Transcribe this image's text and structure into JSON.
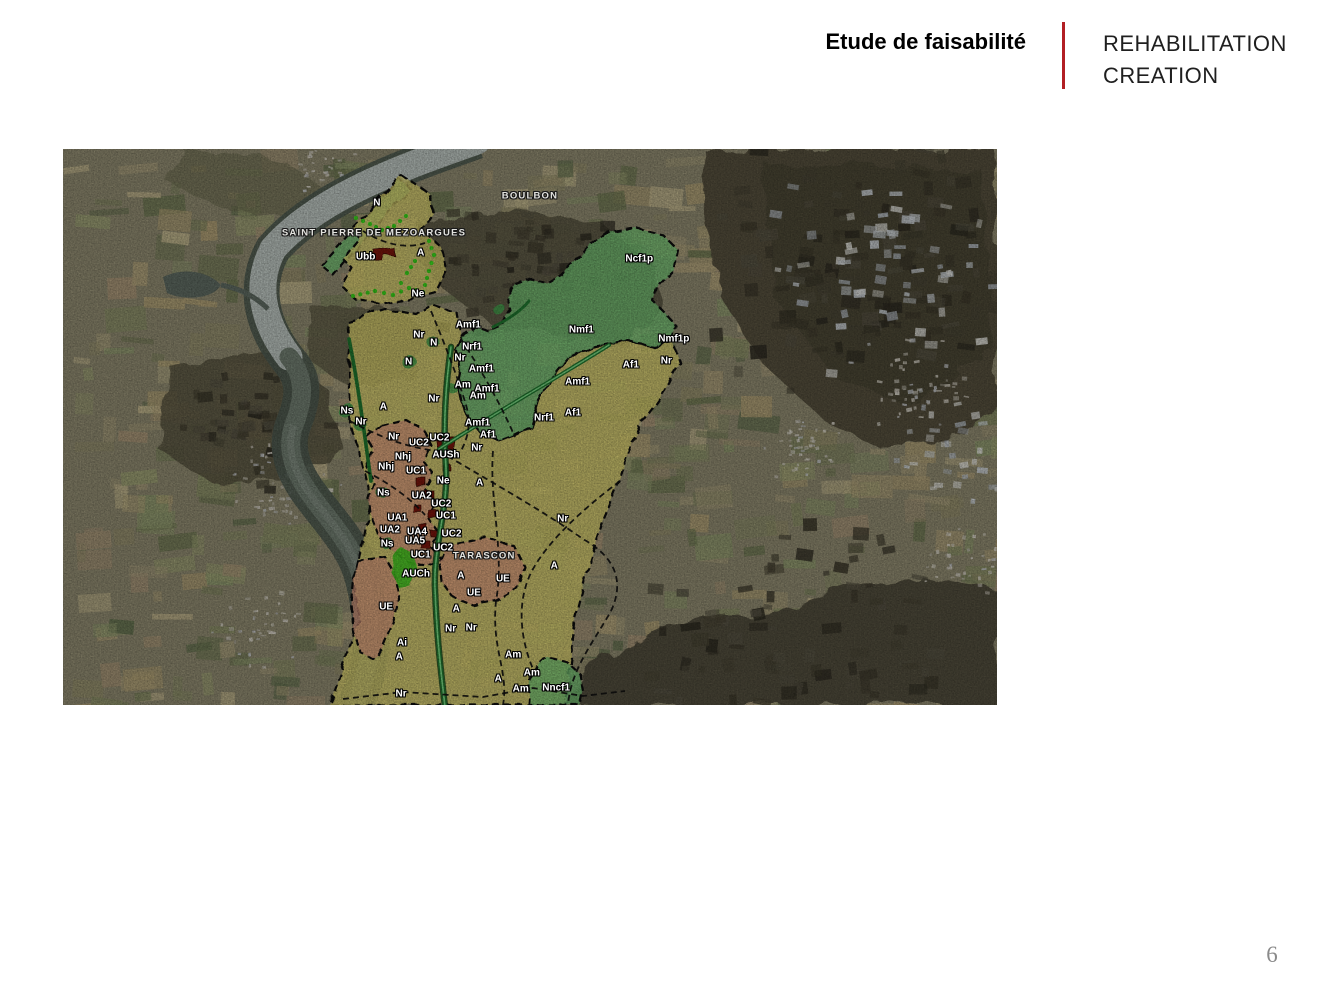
{
  "header": {
    "title": "Etude de faisabilité",
    "subtitle_line1": "REHABILITATION",
    "subtitle_line2": "CREATION",
    "accent_color": "#b21f24"
  },
  "footer": {
    "page_number": "6"
  },
  "map": {
    "kind": "satellite-aerial-with-zoning-overlay",
    "colors": {
      "agricultural_zone": "#d8ce6d",
      "natural_zone": "#74c173",
      "urban_zone": "#d8977c",
      "dense_urban_zone": "#7a150d",
      "future_urban_zone": "#44c522",
      "zone_border": "#0a0a0a",
      "dotted_line_green": "#3bd31d"
    },
    "place_labels": [
      {
        "text": "SAINT PIERRE DE MEZOARGUES",
        "x": 33.3,
        "y": 15.1
      },
      {
        "text": "BOULBON",
        "x": 50.0,
        "y": 8.5
      },
      {
        "text": "TARASCON",
        "x": 45.1,
        "y": 73.2
      }
    ],
    "zone_labels": [
      {
        "text": "N",
        "x": 33.6,
        "y": 9.7
      },
      {
        "text": "Ubb",
        "x": 32.4,
        "y": 19.4
      },
      {
        "text": "A",
        "x": 38.3,
        "y": 18.7
      },
      {
        "text": "Ne",
        "x": 38.0,
        "y": 26.1
      },
      {
        "text": "Ncf1p",
        "x": 61.7,
        "y": 19.8
      },
      {
        "text": "Amf1",
        "x": 43.4,
        "y": 31.7
      },
      {
        "text": "Nr",
        "x": 38.1,
        "y": 33.5
      },
      {
        "text": "N",
        "x": 39.7,
        "y": 34.9
      },
      {
        "text": "Nrf1",
        "x": 43.8,
        "y": 35.6
      },
      {
        "text": "Nmf1",
        "x": 55.5,
        "y": 32.6
      },
      {
        "text": "Nmf1p",
        "x": 65.4,
        "y": 34.2
      },
      {
        "text": "Nr",
        "x": 42.5,
        "y": 37.6
      },
      {
        "text": "Amf1",
        "x": 44.8,
        "y": 39.6
      },
      {
        "text": "Af1",
        "x": 60.8,
        "y": 38.8
      },
      {
        "text": "Nr",
        "x": 64.6,
        "y": 38.1
      },
      {
        "text": "Am",
        "x": 42.8,
        "y": 42.4
      },
      {
        "text": "Amf1",
        "x": 45.4,
        "y": 43.2
      },
      {
        "text": "Amf1",
        "x": 55.1,
        "y": 41.9
      },
      {
        "text": "Am",
        "x": 44.4,
        "y": 44.4
      },
      {
        "text": "Nr",
        "x": 39.7,
        "y": 45.0
      },
      {
        "text": "Ns",
        "x": 30.4,
        "y": 47.1
      },
      {
        "text": "A",
        "x": 34.3,
        "y": 46.4
      },
      {
        "text": "Nr",
        "x": 31.9,
        "y": 49.1
      },
      {
        "text": "N",
        "x": 37.0,
        "y": 38.3
      },
      {
        "text": "Nrf1",
        "x": 51.5,
        "y": 48.4
      },
      {
        "text": "Af1",
        "x": 54.6,
        "y": 47.5
      },
      {
        "text": "Amf1",
        "x": 44.4,
        "y": 49.3
      },
      {
        "text": "Af1",
        "x": 45.5,
        "y": 51.4
      },
      {
        "text": "Nr",
        "x": 35.4,
        "y": 51.8
      },
      {
        "text": "UC2",
        "x": 38.1,
        "y": 52.9
      },
      {
        "text": "UC2",
        "x": 40.3,
        "y": 52.0
      },
      {
        "text": "Nhj",
        "x": 36.4,
        "y": 55.4
      },
      {
        "text": "Nhj",
        "x": 34.6,
        "y": 57.2
      },
      {
        "text": "AUSh",
        "x": 41.0,
        "y": 55.0
      },
      {
        "text": "Nr",
        "x": 44.3,
        "y": 53.8
      },
      {
        "text": "UC1",
        "x": 37.8,
        "y": 57.9
      },
      {
        "text": "Ne",
        "x": 40.7,
        "y": 59.7
      },
      {
        "text": "A",
        "x": 44.6,
        "y": 60.1
      },
      {
        "text": "Ns",
        "x": 34.3,
        "y": 61.9
      },
      {
        "text": "UA2",
        "x": 38.4,
        "y": 62.4
      },
      {
        "text": "UC2",
        "x": 40.5,
        "y": 63.8
      },
      {
        "text": "UA1",
        "x": 35.8,
        "y": 66.4
      },
      {
        "text": "UC1",
        "x": 41.0,
        "y": 66.0
      },
      {
        "text": "UA2",
        "x": 35.0,
        "y": 68.5
      },
      {
        "text": "UA4",
        "x": 37.9,
        "y": 68.9
      },
      {
        "text": "UC2",
        "x": 41.6,
        "y": 69.2
      },
      {
        "text": "Ns",
        "x": 34.7,
        "y": 71.0
      },
      {
        "text": "UA5",
        "x": 37.7,
        "y": 70.5
      },
      {
        "text": "UC2",
        "x": 40.7,
        "y": 71.8
      },
      {
        "text": "UC1",
        "x": 38.3,
        "y": 73.0
      },
      {
        "text": "AUCh",
        "x": 37.8,
        "y": 76.4
      },
      {
        "text": "A",
        "x": 42.6,
        "y": 76.8
      },
      {
        "text": "UE",
        "x": 47.1,
        "y": 77.3
      },
      {
        "text": "A",
        "x": 52.6,
        "y": 75.0
      },
      {
        "text": "Nr",
        "x": 53.5,
        "y": 66.5
      },
      {
        "text": "UE",
        "x": 44.0,
        "y": 79.9
      },
      {
        "text": "UE",
        "x": 34.6,
        "y": 82.4
      },
      {
        "text": "A",
        "x": 42.1,
        "y": 82.7
      },
      {
        "text": "Nr",
        "x": 41.5,
        "y": 86.3
      },
      {
        "text": "Nr",
        "x": 43.7,
        "y": 86.2
      },
      {
        "text": "Ai",
        "x": 36.3,
        "y": 88.8
      },
      {
        "text": "A",
        "x": 36.0,
        "y": 91.4
      },
      {
        "text": "Nr",
        "x": 36.2,
        "y": 98.0
      },
      {
        "text": "Am",
        "x": 48.2,
        "y": 91.0
      },
      {
        "text": "Am",
        "x": 50.2,
        "y": 94.2
      },
      {
        "text": "A",
        "x": 46.6,
        "y": 95.3
      },
      {
        "text": "Am",
        "x": 49.0,
        "y": 97.1
      },
      {
        "text": "Nncf1",
        "x": 52.8,
        "y": 96.9
      }
    ]
  }
}
